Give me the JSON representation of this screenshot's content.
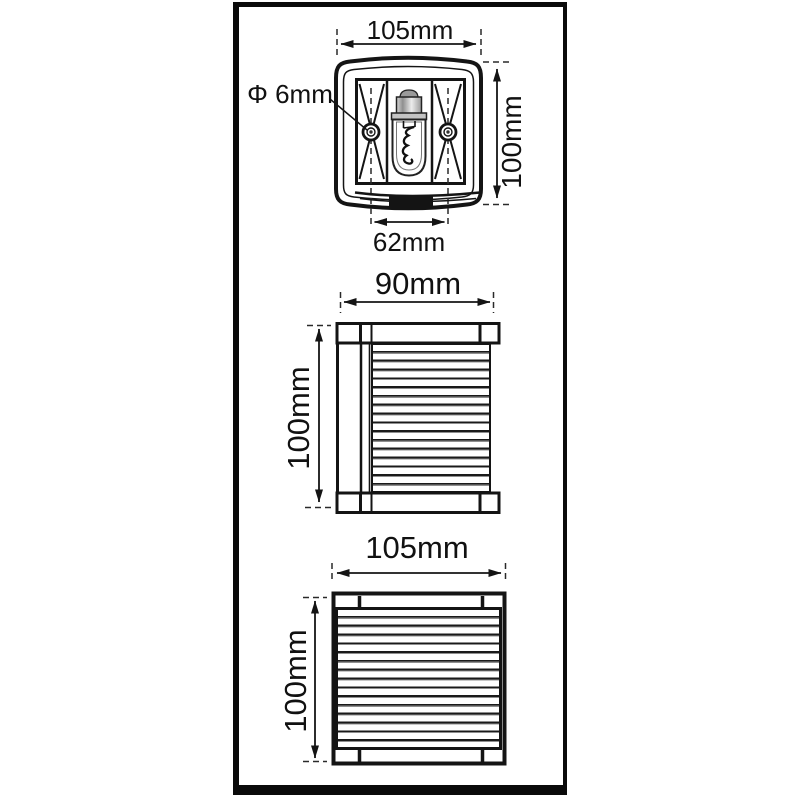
{
  "drawing": {
    "title_semantic": "navigation-light-dimension-drawing",
    "views": {
      "top": {
        "width_label": "105mm",
        "height_label": "100mm",
        "hole_diameter_label": "Φ 6mm",
        "mount_hole_spacing_label": "62mm"
      },
      "side": {
        "width_label": "90mm",
        "height_label": "100mm"
      },
      "front": {
        "width_label": "105mm",
        "height_label": "100mm"
      }
    },
    "colors": {
      "line": "#141414",
      "background": "#ffffff",
      "bulb_metal": "#b5b5b5",
      "connector_block": "#141414"
    }
  }
}
